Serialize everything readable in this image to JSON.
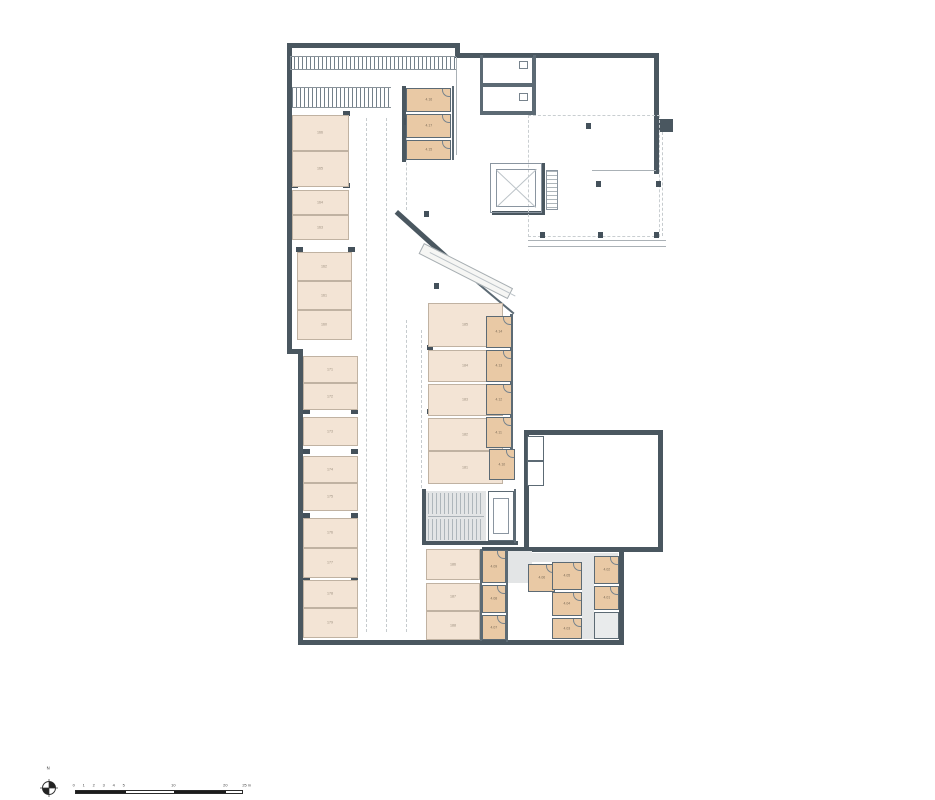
{
  "colors": {
    "wall": "#4a5760",
    "parking_fill": "#f3e4d5",
    "storage_fill": "#e9c9a5",
    "corridor_fill": "#e3e5e6"
  },
  "north_arrow": {
    "label": "N",
    "icon": "compass-crosshair-icon"
  },
  "scale_bar": {
    "unit_labels": [
      "0",
      "1",
      "2",
      "3",
      "4",
      "5"
    ],
    "mid_label": "10",
    "far_label": "20",
    "end_label": "25 m"
  },
  "parking": {
    "upper_left": [
      "166",
      "165",
      "164",
      "163",
      "162",
      "161",
      "160"
    ],
    "lower_left": [
      "171",
      "172",
      "173",
      "174",
      "175",
      "176",
      "177",
      "178",
      "179"
    ],
    "middle": [
      "185",
      "184",
      "183",
      "182",
      "181"
    ],
    "bottom": [
      "186",
      "187",
      "188"
    ]
  },
  "storage": {
    "top_block": [
      "4.16",
      "4.17",
      "4.15"
    ],
    "middle_column": [
      "4.14",
      "4.13",
      "4.12",
      "4.11"
    ],
    "offset_room": [
      "4.10"
    ],
    "bottom_left": [
      "4.09",
      "4.08",
      "4.07"
    ],
    "cluster_single": [
      "4.06"
    ],
    "cluster_stack": [
      "4.05",
      "4.04",
      "4.03"
    ],
    "right_column": [
      "4.02",
      "4.01"
    ]
  }
}
